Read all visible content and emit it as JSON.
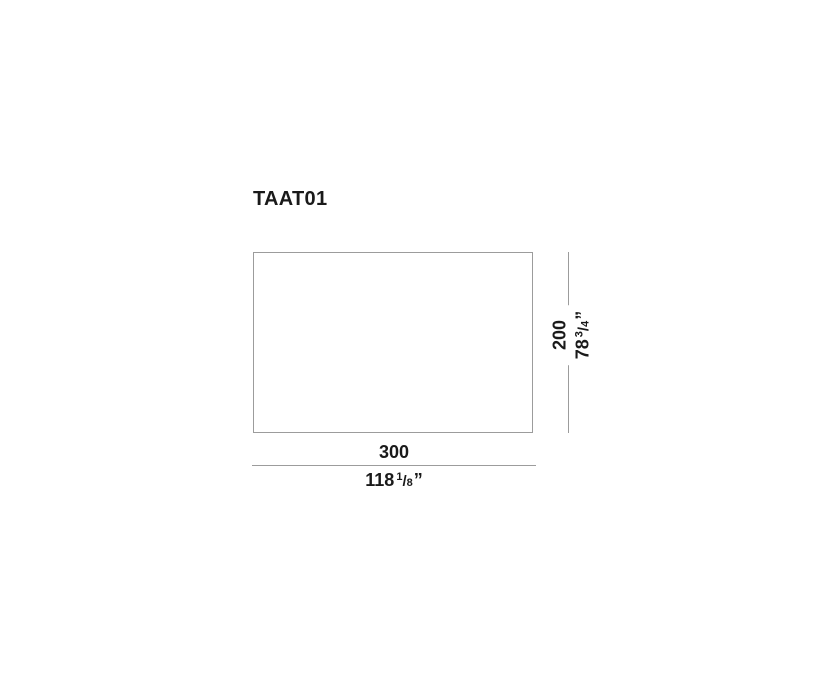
{
  "page": {
    "background_color": "#ffffff",
    "line_color": "#9c9c9c",
    "text_color": "#1a1a1a"
  },
  "drawing": {
    "product_code": "TAAT01",
    "width_dimension": {
      "cm": "300",
      "inches_whole": "118",
      "fraction_numerator": "1",
      "fraction_slash": "/",
      "fraction_denominator": "8",
      "unit_mark": "”"
    },
    "height_dimension": {
      "cm": "200",
      "inches_whole": "78",
      "fraction_numerator": "3",
      "fraction_slash": "/",
      "fraction_denominator": "4",
      "unit_mark": "”"
    }
  }
}
